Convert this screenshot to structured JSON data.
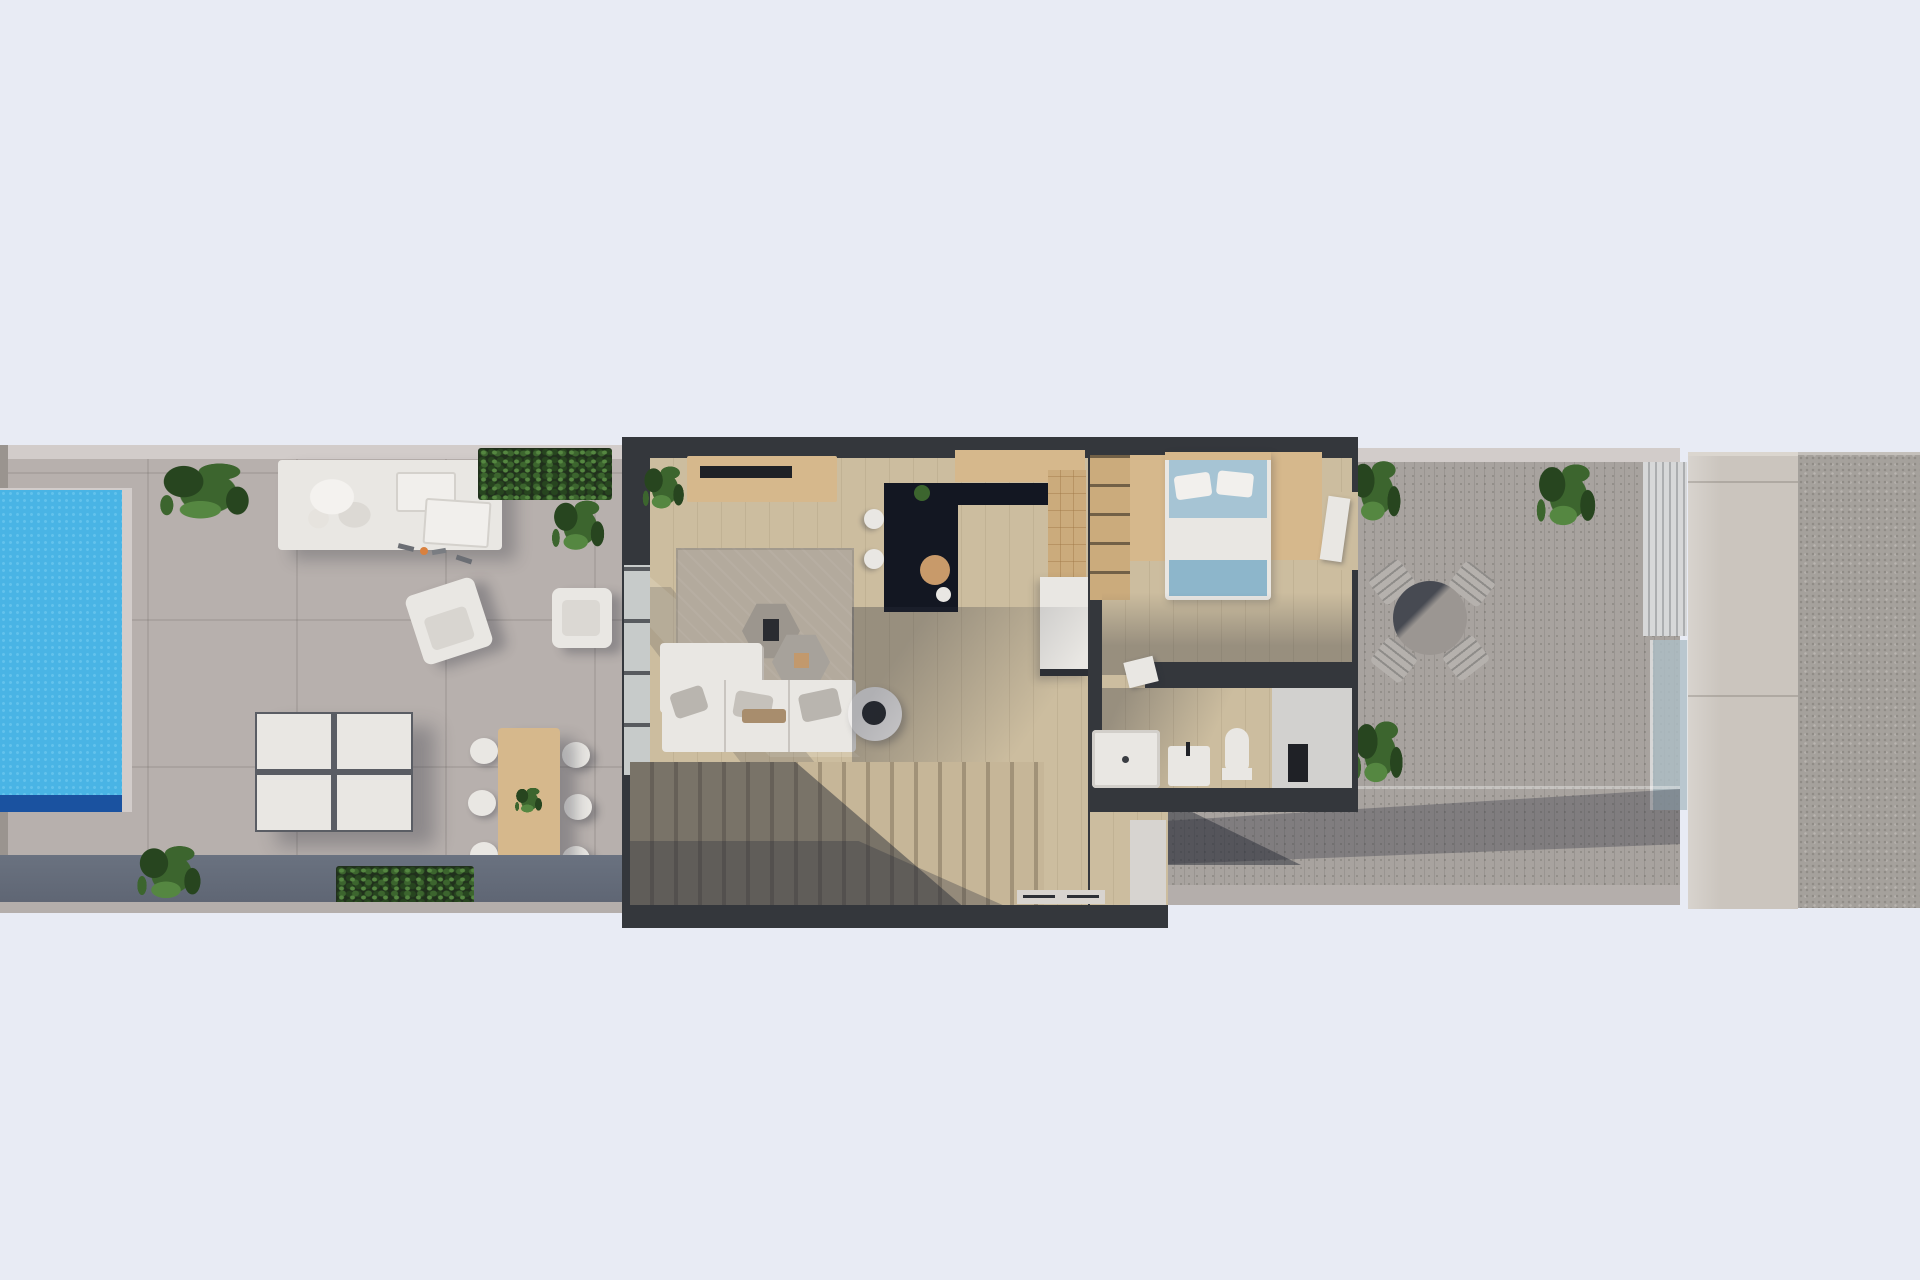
{
  "meta": {
    "title": "Top-down 3D architectural floor plan render",
    "description": "Aerial render of a narrow villa plot: pool terrace with loungers and dining set on the left, open-plan living room, kitchen, bedroom and bathroom in the centre, staircase, and a rear decked terrace with bistro set, stone paving and gravel strip on the right."
  },
  "labels": {
    "scene": "Floor plan render",
    "poolTerrace": "Pool terrace",
    "pool": "Swimming pool",
    "daybed": "Outdoor day bed",
    "planterTop": "Planter with shrubs",
    "pottedPlant": "Potted plant",
    "armchair": "Outdoor lounge chair",
    "outdoorChair": "Outdoor chair",
    "loungers": "Sun loungers",
    "diningSet": "Outdoor dining table with six chairs",
    "slateWall": "Terrace boundary wall",
    "plant": "Plant",
    "house": "House interior",
    "livingRoom": "Living room",
    "sideboard": "Sideboard with TV",
    "rug": "Area rug",
    "coffeeTable": "Coffee table",
    "sofa": "Corner sofa",
    "sideTable": "Round side table",
    "slidingDoor": "Sliding glass door",
    "kitchen": "Kitchen",
    "island": "Kitchen island",
    "counter": "Kitchen counter",
    "stool": "Bar stool",
    "whiteDoor": "Open white door",
    "stairs": "Staircase",
    "windowsill": "Window",
    "hallway": "Hallway",
    "bedroom": "Bedroom",
    "bed": "Double bed",
    "wardrobe": "Wardrobe unit",
    "shelving": "Open shelving unit",
    "bedroomDoor": "Door to terrace",
    "bathroom": "Bathroom",
    "shower": "Shower tray",
    "vanity": "Washbasin",
    "toilet": "Toilet",
    "towelStand": "Towel stand",
    "rearTerrace": "Rear decked terrace",
    "bistroTable": "Round outdoor table",
    "bistroChair": "Outdoor folding chair",
    "balustrade": "Glass balustrade",
    "stonePath": "Stone paving strip",
    "gravel": "Gravel strip"
  },
  "colors": {
    "bg": "#e8ebf4",
    "deck": "#b7b0ad",
    "deck_light": "#d2cccA",
    "tile_line": "rgba(95,90,85,0.16)",
    "slate": "#5f6674",
    "curb": "#b4aeab",
    "edge": "#9a948f",
    "pool_water": "#49b4e5",
    "pool_water_light": "#63c2ec",
    "pool_deep": "#1a52a0",
    "house_wall": "#34373c",
    "floor_wood": "#ccbd9f",
    "floor_line": "rgba(125,108,82,0.14)",
    "rug": "#b3aa9d",
    "tan": "#d6b88c",
    "tan_deep": "#cbab7c",
    "tv": "#1f2126",
    "island": "#131722",
    "white": "#e9e7e3",
    "white_dim": "#d7d4d0",
    "bed_blue": "#a6c4d4",
    "bed_blue_deep": "#8db6cb",
    "bath_gray": "#d2d1cf",
    "stair": "#c6b698",
    "stair_line": "rgba(75,64,48,0.30)",
    "decking": "#a8a39f",
    "deck_line": "rgba(70,68,66,0.15)",
    "stone": "#cbc5be",
    "stone_line": "rgba(110,104,96,0.30)",
    "gravel": "#a5a19c",
    "gravel_dark": "#8f8b86",
    "gravel_light": "#b8b4af",
    "glass": "#aebfc6",
    "frame_light": "#d7d8d9",
    "plant_dark": "#27451f",
    "plant_mid": "#3c652e",
    "plant_light": "#558741",
    "soil": "#20301c",
    "shadow": "rgba(42,46,58,0.32)",
    "shadow_strong": "rgba(38,42,52,0.48)",
    "beam": "rgba(255,250,240,0.18)",
    "wood_board": "#c89a6a",
    "accent_orange": "#d9813f"
  }
}
